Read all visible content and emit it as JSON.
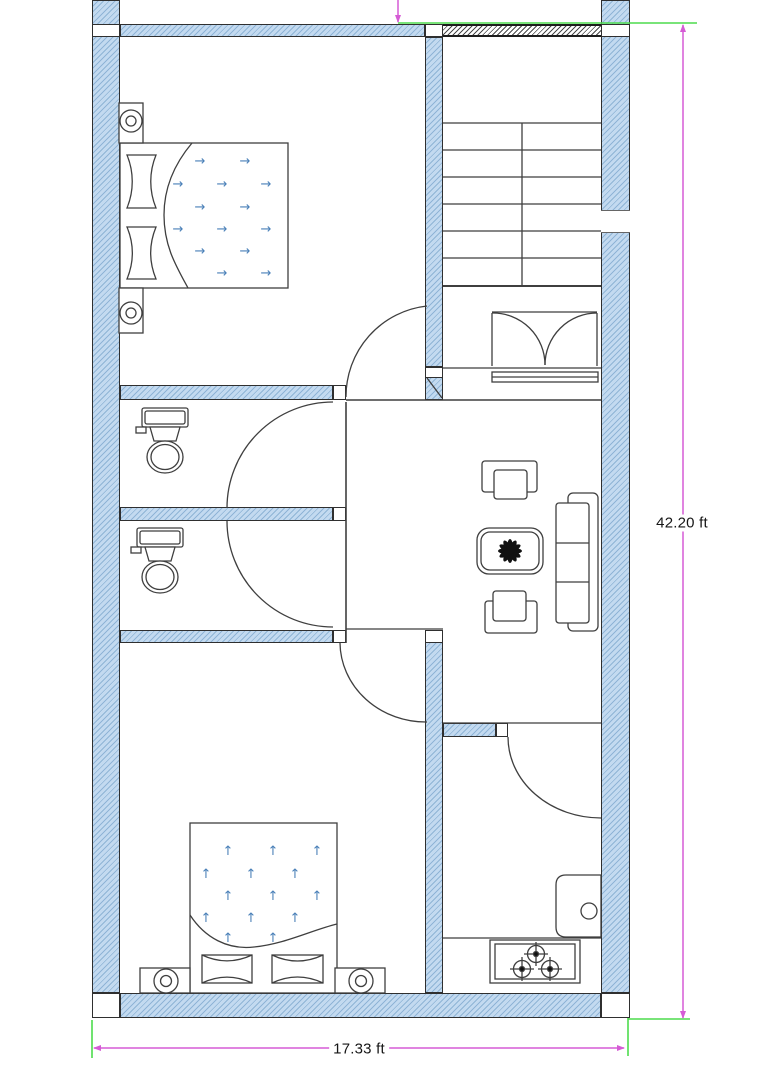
{
  "drawing": {
    "type": "architectural-floor-plan",
    "dimensions": {
      "height_label": "42.20 ft",
      "width_label": "17.33 ft"
    },
    "glyphs": {
      "blanket_arrow_right": "→",
      "blanket_arrow_up": "↑"
    },
    "colors": {
      "wall_fill": "#c3daf0",
      "wall_hatch": "#8fb4d6",
      "wall_outline": "#2f2f2f",
      "dark_lintel_hatch": "#4a4a4a",
      "dimension_line": "#d55bd5",
      "extension_line": "#4ddc4d",
      "drawing_line": "#3f3f3f",
      "blanket_arrow": "#4a80b8",
      "plant_symbol": "#111111",
      "background": "#ffffff"
    },
    "features": {
      "stair_tread_count": 7,
      "rooms": [
        "bedroom-top",
        "staircase-hall",
        "bathroom-1",
        "bathroom-2",
        "living-area",
        "bedroom-bottom",
        "kitchen"
      ],
      "fixtures": [
        "bed",
        "nightstand-lamp",
        "toilet",
        "sofa",
        "armchair",
        "coffee-table",
        "plant",
        "stove",
        "sink",
        "double-entry-door"
      ]
    }
  }
}
